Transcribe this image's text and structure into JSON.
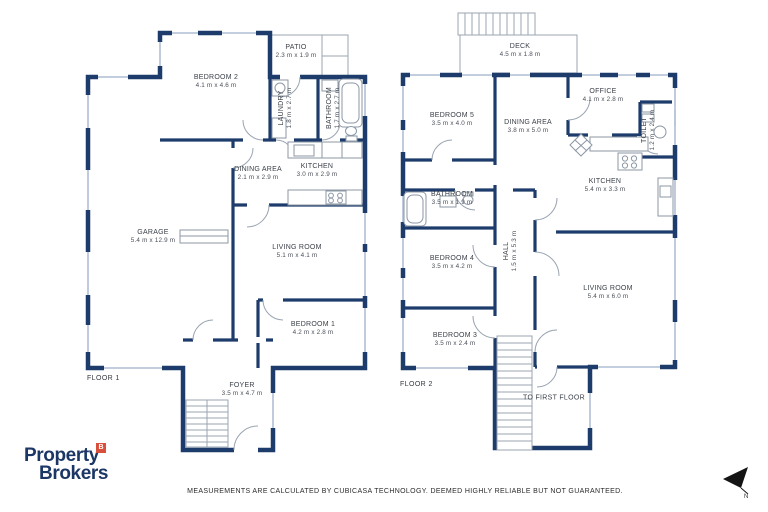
{
  "meta": {
    "disclaimer": "MEASUREMENTS ARE CALCULATED BY CUBICASA TECHNOLOGY. DEEMED HIGHLY RELIABLE BUT NOT GUARANTEED.",
    "north_marker": "N"
  },
  "colors": {
    "wall_navy": "#1e3c6b",
    "window_blue": "#b9c7da",
    "thin_line_gray": "#9aa4b2",
    "label_text": "#3b4048",
    "logo_navy": "#1c3766",
    "badge_red": "#d84f3b"
  },
  "logo": {
    "line1": "Property",
    "line2": "Brokers",
    "badge": "B"
  },
  "floor1": {
    "label": "FLOOR 1",
    "rooms": [
      {
        "name": "BEDROOM 2",
        "dims": "4.1 m x 4.6 m"
      },
      {
        "name": "PATIO",
        "dims": "2.3 m x 1.9 m"
      },
      {
        "name": "LAUNDRY",
        "dims": "1.8 m x 2.7 m"
      },
      {
        "name": "BATHROOM",
        "dims": "1.7 m x 2.7 m"
      },
      {
        "name": "DINING AREA",
        "dims": "2.1 m x 2.9 m"
      },
      {
        "name": "KITCHEN",
        "dims": "3.0 m x 2.9 m"
      },
      {
        "name": "GARAGE",
        "dims": "5.4 m x 12.9 m"
      },
      {
        "name": "LIVING ROOM",
        "dims": "5.1 m x 4.1 m"
      },
      {
        "name": "BEDROOM 1",
        "dims": "4.2 m x 2.8 m"
      },
      {
        "name": "FOYER",
        "dims": "3.5 m x 4.7 m"
      }
    ]
  },
  "floor2": {
    "label": "FLOOR 2",
    "stair_note": "TO FIRST FLOOR",
    "rooms": [
      {
        "name": "DECK",
        "dims": "4.5 m x 1.8 m"
      },
      {
        "name": "BEDROOM 5",
        "dims": "3.5 m x 4.0 m"
      },
      {
        "name": "DINING AREA",
        "dims": "3.8 m x 5.0 m"
      },
      {
        "name": "OFFICE",
        "dims": "4.1 m x 2.8 m"
      },
      {
        "name": "TOILET",
        "dims": "1.2 m x 2.4 m"
      },
      {
        "name": "KITCHEN",
        "dims": "5.4 m x 3.3 m"
      },
      {
        "name": "BATHROOM",
        "dims": "3.5 m x 1.9 m"
      },
      {
        "name": "BEDROOM 4",
        "dims": "3.5 m x 4.2 m"
      },
      {
        "name": "HALL",
        "dims": "1.5 m x 5.3 m"
      },
      {
        "name": "BEDROOM 3",
        "dims": "3.5 m x 2.4 m"
      },
      {
        "name": "LIVING ROOM",
        "dims": "5.4 m x 6.0 m"
      }
    ]
  }
}
